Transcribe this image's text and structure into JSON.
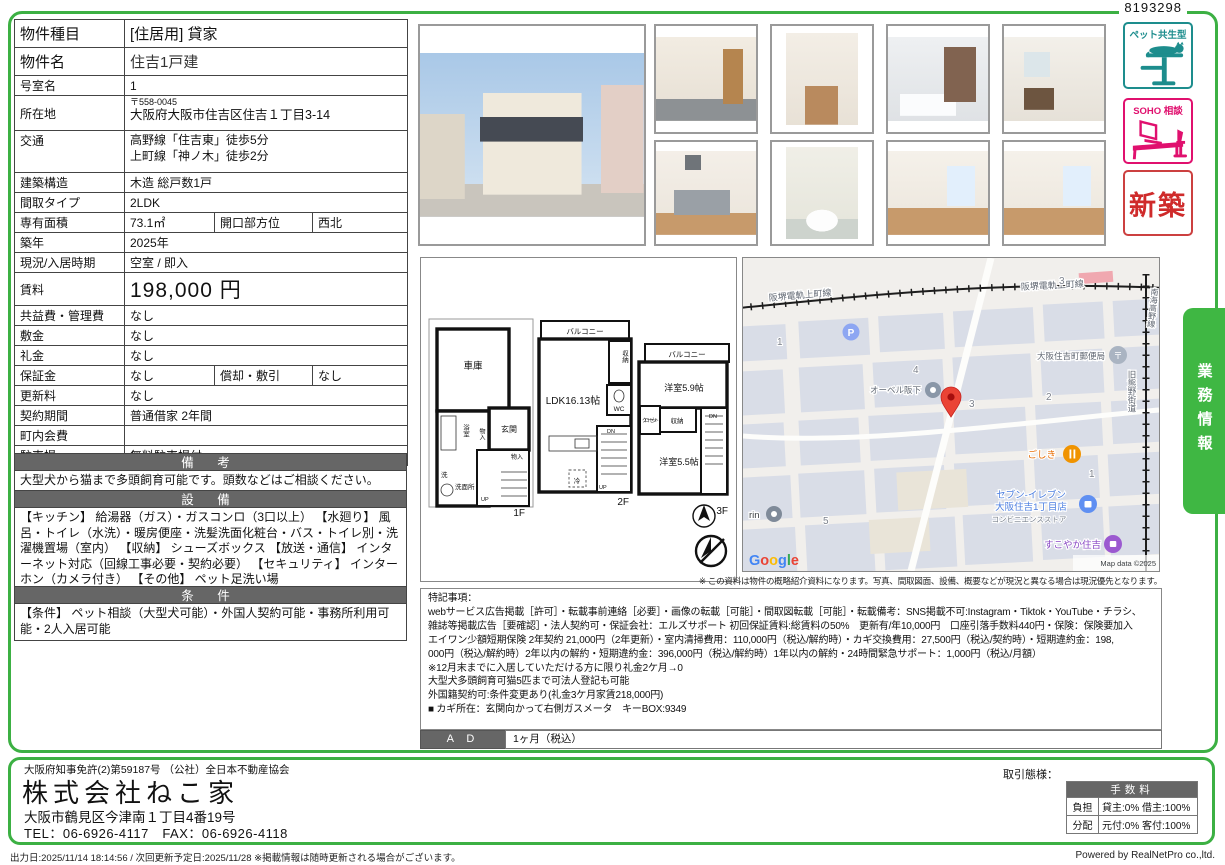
{
  "doc_id": "8193298",
  "property_table": {
    "rows": [
      {
        "label": "物件種目",
        "value": "[住居用] 貸家"
      },
      {
        "label": "物件名",
        "value": "住吉1戸建"
      },
      {
        "label": "号室名",
        "value": "1"
      },
      {
        "label": "所在地",
        "value1": "〒558-0045",
        "value2": "大阪府大阪市住吉区住吉１丁目3-14"
      },
      {
        "label": "交通",
        "value1": "高野線「住吉東」徒歩5分",
        "value2": "上町線「神ノ木」徒歩2分"
      },
      {
        "label": "建築構造",
        "value": "木造 総戸数1戸"
      },
      {
        "label": "間取タイプ",
        "value": "2LDK"
      },
      {
        "label": "専有面積",
        "value": "73.1㎡",
        "label2": "開口部方位",
        "value2": "西北"
      },
      {
        "label": "築年",
        "value": "2025年"
      },
      {
        "label": "現況/入居時期",
        "value": "空室 / 即入"
      },
      {
        "label": "賃料",
        "value": "198,000 円"
      },
      {
        "label": "共益費・管理費",
        "value": "なし"
      },
      {
        "label": "敷金",
        "value": "なし"
      },
      {
        "label": "礼金",
        "value": "なし"
      },
      {
        "label": "保証金",
        "value": "なし",
        "label2": "償却・敷引",
        "value2": "なし"
      },
      {
        "label": "更新料",
        "value": "なし"
      },
      {
        "label": "契約期間",
        "value": "普通借家 2年間"
      },
      {
        "label": "町内会費",
        "value": ""
      },
      {
        "label": "駐車場",
        "value": "無料駐車場付"
      }
    ]
  },
  "sections": {
    "remarks_header": "備 考",
    "remarks_text": "大型犬から猫まで多頭飼育可能です。頭数などはご相談ください。",
    "equipment_header": "設 備",
    "equipment_text": "【キッチン】 給湯器（ガス）・ガスコンロ（3口以上） 【水廻り】 風呂・トイレ（水洗）・暖房便座・洗髪洗面化粧台・バス・トイレ別・洗濯機置場（室内） 【収納】 シューズボックス 【放送・通信】 インターネット対応（回線工事必要・契約必要） 【セキュリティ】 インターホン（カメラ付き） 【その他】 ペット足洗い場",
    "conditions_header": "条 件",
    "conditions_text": "【条件】 ペット相談（大型犬可能）・外国人契約可能・事務所利用可能・2人入居可能"
  },
  "badges": {
    "pet": "ペット共生型",
    "soho": "SOHO 相談",
    "shinchiku": "新築"
  },
  "side_tab": "業務情報",
  "floorplan": {
    "f1": {
      "label": "1F",
      "garage": "車庫",
      "entry": "玄関",
      "bath": "浴室",
      "st1": "物入",
      "st2": "物入",
      "wash": "洗",
      "washroom": "洗面所",
      "up": "UP"
    },
    "f2": {
      "label": "2F",
      "balcony": "バルコニー",
      "ldk": "LDK16.13帖",
      "closet": "収納",
      "wc": "WC",
      "fridge": "冷",
      "up": "UP",
      "dn": "DN"
    },
    "f3": {
      "label": "3F",
      "balcony": "バルコニー",
      "room1": "洋室5.9帖",
      "closet1": "クローゼット",
      "closet2": "収納",
      "room2": "洋室5.5帖",
      "dn": "DN"
    }
  },
  "map": {
    "railway_label": "阪堺電軌上町線",
    "railway_label2": "阪堺電軌上町線",
    "nankai_label": "南海高野線",
    "kumano_label": "旧熊野街道",
    "numbers": [
      "3",
      "1",
      "4",
      "3",
      "2",
      "5",
      "1"
    ],
    "parking_p": "P",
    "post_office": "大阪住吉町郵便局",
    "post_mark": "〒",
    "aubel": "オーベル阪下",
    "goshiki": "ごしき",
    "seven1": "セブン-イレブン",
    "seven2": "大阪住吉1丁目店",
    "seven3": "コンビニエンスストア",
    "sukoyaka": "すこやか住吉",
    "rin": "rin",
    "google_letters": [
      "G",
      "o",
      "o",
      "g",
      "l",
      "e"
    ],
    "map_data": "Map data ©2025"
  },
  "map_note": "※ この資料は物件の概略紹介資料になります。写真、間取図面、設備、概要などが現況と異なる場合は現況優先となります。",
  "special_notes": {
    "title": "特記事項：",
    "lines": [
      "webサービス広告掲載［許可］・転載事前連絡［必要］・画像の転載［可能］・間取図転載［可能］・転載備考：SNS掲載不可:Instagram・Tiktok・YouTube・チラシ、",
      "雑誌等掲載広告［要確認］・法人契約可・保証会社：エルズサポート 初回保証賃料:総賃料の50%　更新有/年10,000円　口座引落手数料440円・保険：保険要加入",
      "エイワン少額短期保険 2年契約 21,000円（2年更新）・室内清掃費用：110,000円（税込/解約時）・カギ交換費用：27,500円（税込/契約時）・短期違約金：198,",
      "000円（税込/解約時）2年以内の解約・短期違約金：396,000円（税込/解約時）1年以内の解約・24時間緊急サポート：1,000円（税込/月額）",
      "※12月末までに入居していただける方に限り礼金2ケ月→0",
      "大型犬多頭飼育可猫5匹まで可法人登記も可能",
      "外国籍契約可:条件変更あり(礼金3ケ月家賃218,000円)",
      "■ カギ所在：玄関向かって右側ガスメータ　キーBOX:9349"
    ]
  },
  "ad": {
    "label": "A D",
    "value": "1ヶ月（税込）"
  },
  "company": {
    "license": "大阪府知事免許(2)第59187号 （公社）全日本不動産協会",
    "name": "株式会社ねこ家",
    "address": "大阪市鶴見区今津南１丁目4番19号",
    "tel": "TEL：06-6926-4117　FAX：06-6926-4118"
  },
  "transaction": {
    "title": "取引態様：",
    "header": "手数料",
    "rows": [
      {
        "label": "負担",
        "value": "貸主:0% 借主:100%"
      },
      {
        "label": "分配",
        "value": "元付:0% 客付:100%"
      }
    ]
  },
  "footer": {
    "left": "出力日:2025/11/14 18:14:56 / 次回更新予定日:2025/11/28 ※掲載情報は随時更新される場合がございます。",
    "right": "Powered by RealNetPro co.,ltd."
  }
}
